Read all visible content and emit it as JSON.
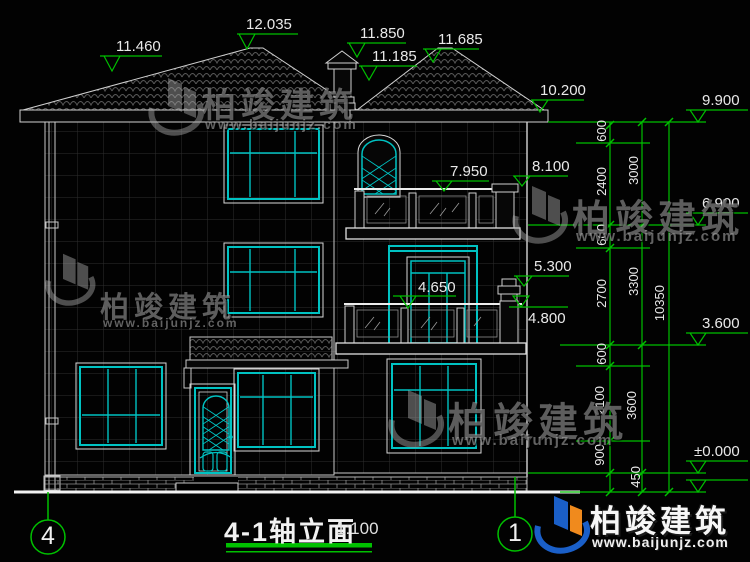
{
  "drawing": {
    "title": "4-1轴立面",
    "scale": "1:100",
    "axis_left": "4",
    "axis_right": "1"
  },
  "watermark": {
    "brand": "柏竣建筑",
    "url": "www.baijunjz.com"
  },
  "elevations": {
    "eave_left": "11.460",
    "ridge_main": "12.035",
    "chimney_top": "11.850",
    "chimney_base": "11.185",
    "ridge_right": "11.685",
    "eave_right": "10.200",
    "parapet_right": "9.900",
    "pillar_3f": "8.100",
    "rail_3f": "7.950",
    "floor_3f": "6.900",
    "pillar_2f": "5.300",
    "window_2f": "4.650",
    "rail_2f": "4.800",
    "floor_2f": "3.600",
    "ground": "±0.000"
  },
  "dim_chains": {
    "inner": [
      "600",
      "2400",
      "600",
      "2700",
      "600",
      "2100",
      "900"
    ],
    "middle": [
      "3000",
      "3300",
      "3600",
      "450"
    ],
    "outer": [
      "10350"
    ]
  }
}
